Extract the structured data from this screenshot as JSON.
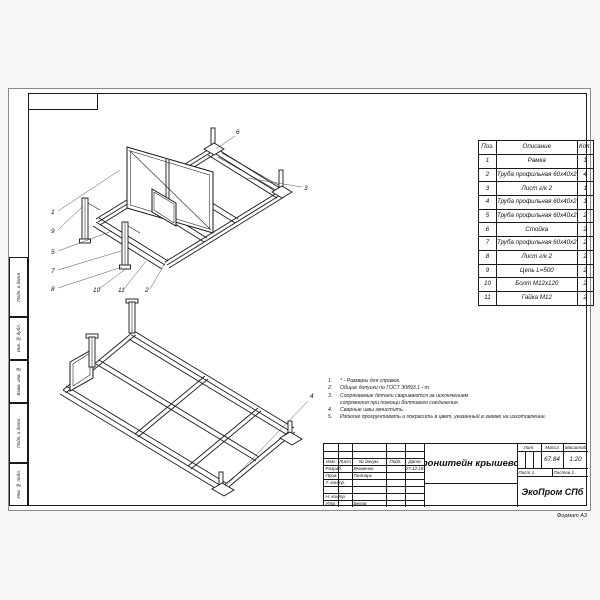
{
  "page": {
    "format_note": "Формат А3"
  },
  "margin_stamps": {
    "cells": [
      {
        "label": "Подп. и дата"
      },
      {
        "label": "Инв. № дубл."
      },
      {
        "label": "Взам. инв. №"
      },
      {
        "label": "Подп. и дата"
      },
      {
        "label": "Инв. № подл."
      }
    ]
  },
  "parts_table": {
    "headers": {
      "pos": "Поз.",
      "description": "Описание",
      "qty": "Кол."
    },
    "rows": [
      {
        "pos": "1",
        "description": "Рамка",
        "qty": "1"
      },
      {
        "pos": "2",
        "description": "Труба профильная 60х40х2",
        "qty": "4"
      },
      {
        "pos": "3",
        "description": "Лист г/к 2",
        "qty": "1"
      },
      {
        "pos": "4",
        "description": "Труба профильная 60х40х2",
        "qty": "1"
      },
      {
        "pos": "5",
        "description": "Труба профильная 60х40х2",
        "qty": "2"
      },
      {
        "pos": "6",
        "description": "Стойка",
        "qty": "2"
      },
      {
        "pos": "7",
        "description": "Труба профильная 60х40х2",
        "qty": "2"
      },
      {
        "pos": "8",
        "description": "Лист г/к 2",
        "qty": "2"
      },
      {
        "pos": "9",
        "description": "Цепь L=500",
        "qty": "2"
      },
      {
        "pos": "10",
        "description": "Болт М12х120",
        "qty": "2"
      },
      {
        "pos": "11",
        "description": "Гайка М12",
        "qty": "2"
      }
    ]
  },
  "notes": {
    "items": [
      {
        "num": "1.",
        "text": "* - Размеры для справок."
      },
      {
        "num": "2.",
        "text": "Общие допуски по ГОСТ 30893.1 - m."
      },
      {
        "num": "3.",
        "text": "Сопрягаемые детали свариваются за исключением сопряжения при помощи болтового соединения."
      },
      {
        "num": "4.",
        "text": "Сварные швы зачистить."
      },
      {
        "num": "5.",
        "text": "Изделие прогрунтовать и покрасить в цвет, указанный в заявке на изготовление."
      }
    ]
  },
  "title_block": {
    "header_cols": {
      "izm": "Изм.",
      "list": "Лист",
      "doc": "№ докум.",
      "podp": "Подп.",
      "data": "Дата"
    },
    "rows": {
      "razrab_label": "Разраб.",
      "razrab_name": "Яковенко",
      "razrab_date": "27.12.18",
      "prov_label": "Пров.",
      "prov_name": "Гонтарь",
      "tkontr_label": "Т. контр.",
      "nkontr_label": "Н. контр.",
      "utv_label": "Утв.",
      "utv_name": "Белов"
    },
    "title": "Кронштейн крышевой",
    "lit_label": "Лит.",
    "mass_label": "Масса",
    "scale_label": "Масштаб",
    "mass": "67.84",
    "scale": "1:20",
    "sheet": "Лист 1",
    "sheets": "Листов 1",
    "company": "ЭкоПром СПб"
  },
  "callouts": {
    "top_view": [
      "1",
      "9",
      "5",
      "7",
      "8",
      "10",
      "11",
      "2",
      "6",
      "3"
    ],
    "bottom_view": [
      "4"
    ]
  }
}
